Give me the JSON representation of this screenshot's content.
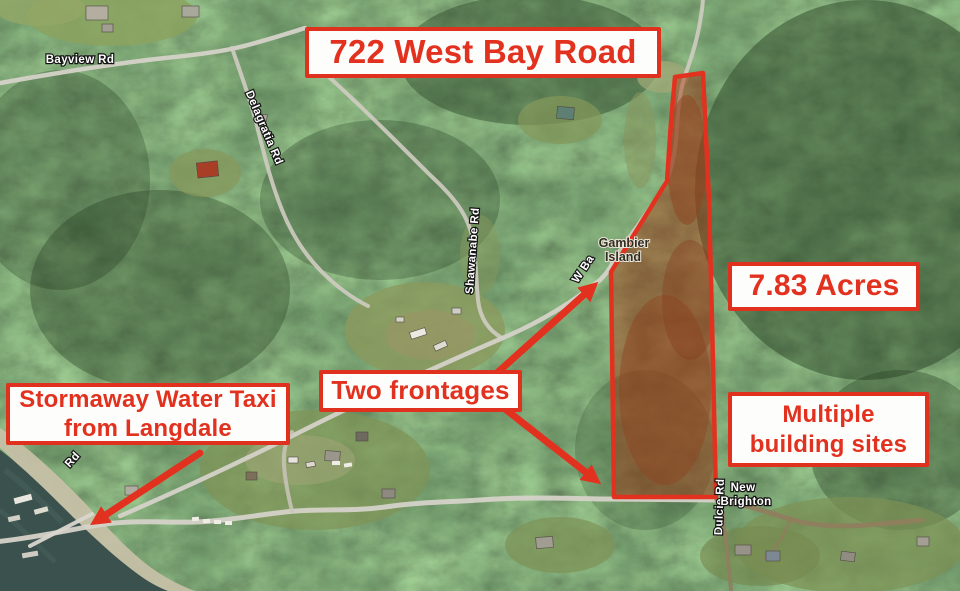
{
  "annotations": {
    "title": "722 West Bay Road",
    "acreage": "7.83 Acres",
    "frontages": "Two frontages",
    "building_sites": {
      "line1": "Multiple",
      "line2": "building sites"
    },
    "water_taxi": {
      "line1": "Stormaway Water Taxi",
      "line2": "from Langdale"
    }
  },
  "map_labels": {
    "bayview_rd": "Bayview Rd",
    "delagratia_rd": "Delagratia Rd",
    "shawanabe_rd": "Shawanabe Rd",
    "gambier_island": {
      "line1": "Gambier",
      "line2": "Island"
    },
    "west_bay_rd_partial": "W Ba",
    "dulcie_rd": "Dulcie Rd",
    "new_brighton": {
      "line1": "New",
      "line2": "Brighton"
    },
    "shore_rd_partial": "Rd"
  },
  "colors": {
    "annotation_red": "#e2321f",
    "callout_background": "#fdfdfb",
    "parcel_outline": "#e2321f",
    "parcel_tint": "rgba(170,40,8,0.42)",
    "water": "#3a514d",
    "road_paved": "#d5d2c8",
    "road_dirt": "#8f7e5e"
  }
}
